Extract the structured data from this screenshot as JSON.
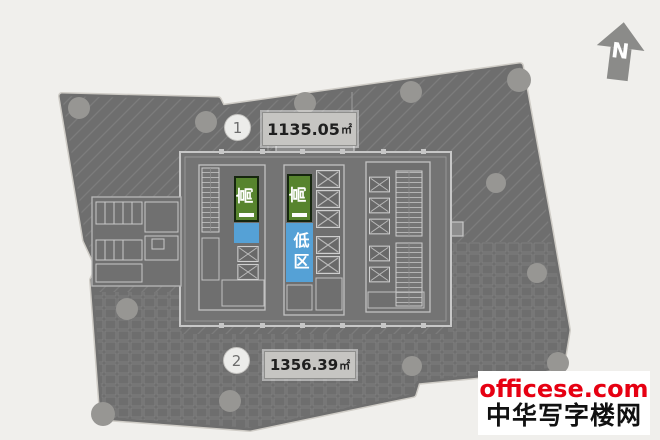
{
  "page": {
    "background": "#f0efec"
  },
  "compass": {
    "label": "N"
  },
  "units": [
    {
      "number": "1",
      "area": "1135.05",
      "unit": "㎡"
    },
    {
      "number": "2",
      "area": "1356.39",
      "unit": "㎡"
    }
  ],
  "zones": {
    "high": "高",
    "low": "低区"
  },
  "watermark": {
    "site": "officese.com",
    "name": "中华写字楼网"
  },
  "colors": {
    "plate_gray": "#6e6e6e",
    "high_zone_green": "#57842e",
    "low_zone_blue": "#55a1d6",
    "core_wall": "#c7c7c7",
    "column_gray": "#979693",
    "label_box_bg": "#c6c5c2",
    "watermark_red": "#e60012",
    "north_arrow_gray": "#8b8b89"
  }
}
